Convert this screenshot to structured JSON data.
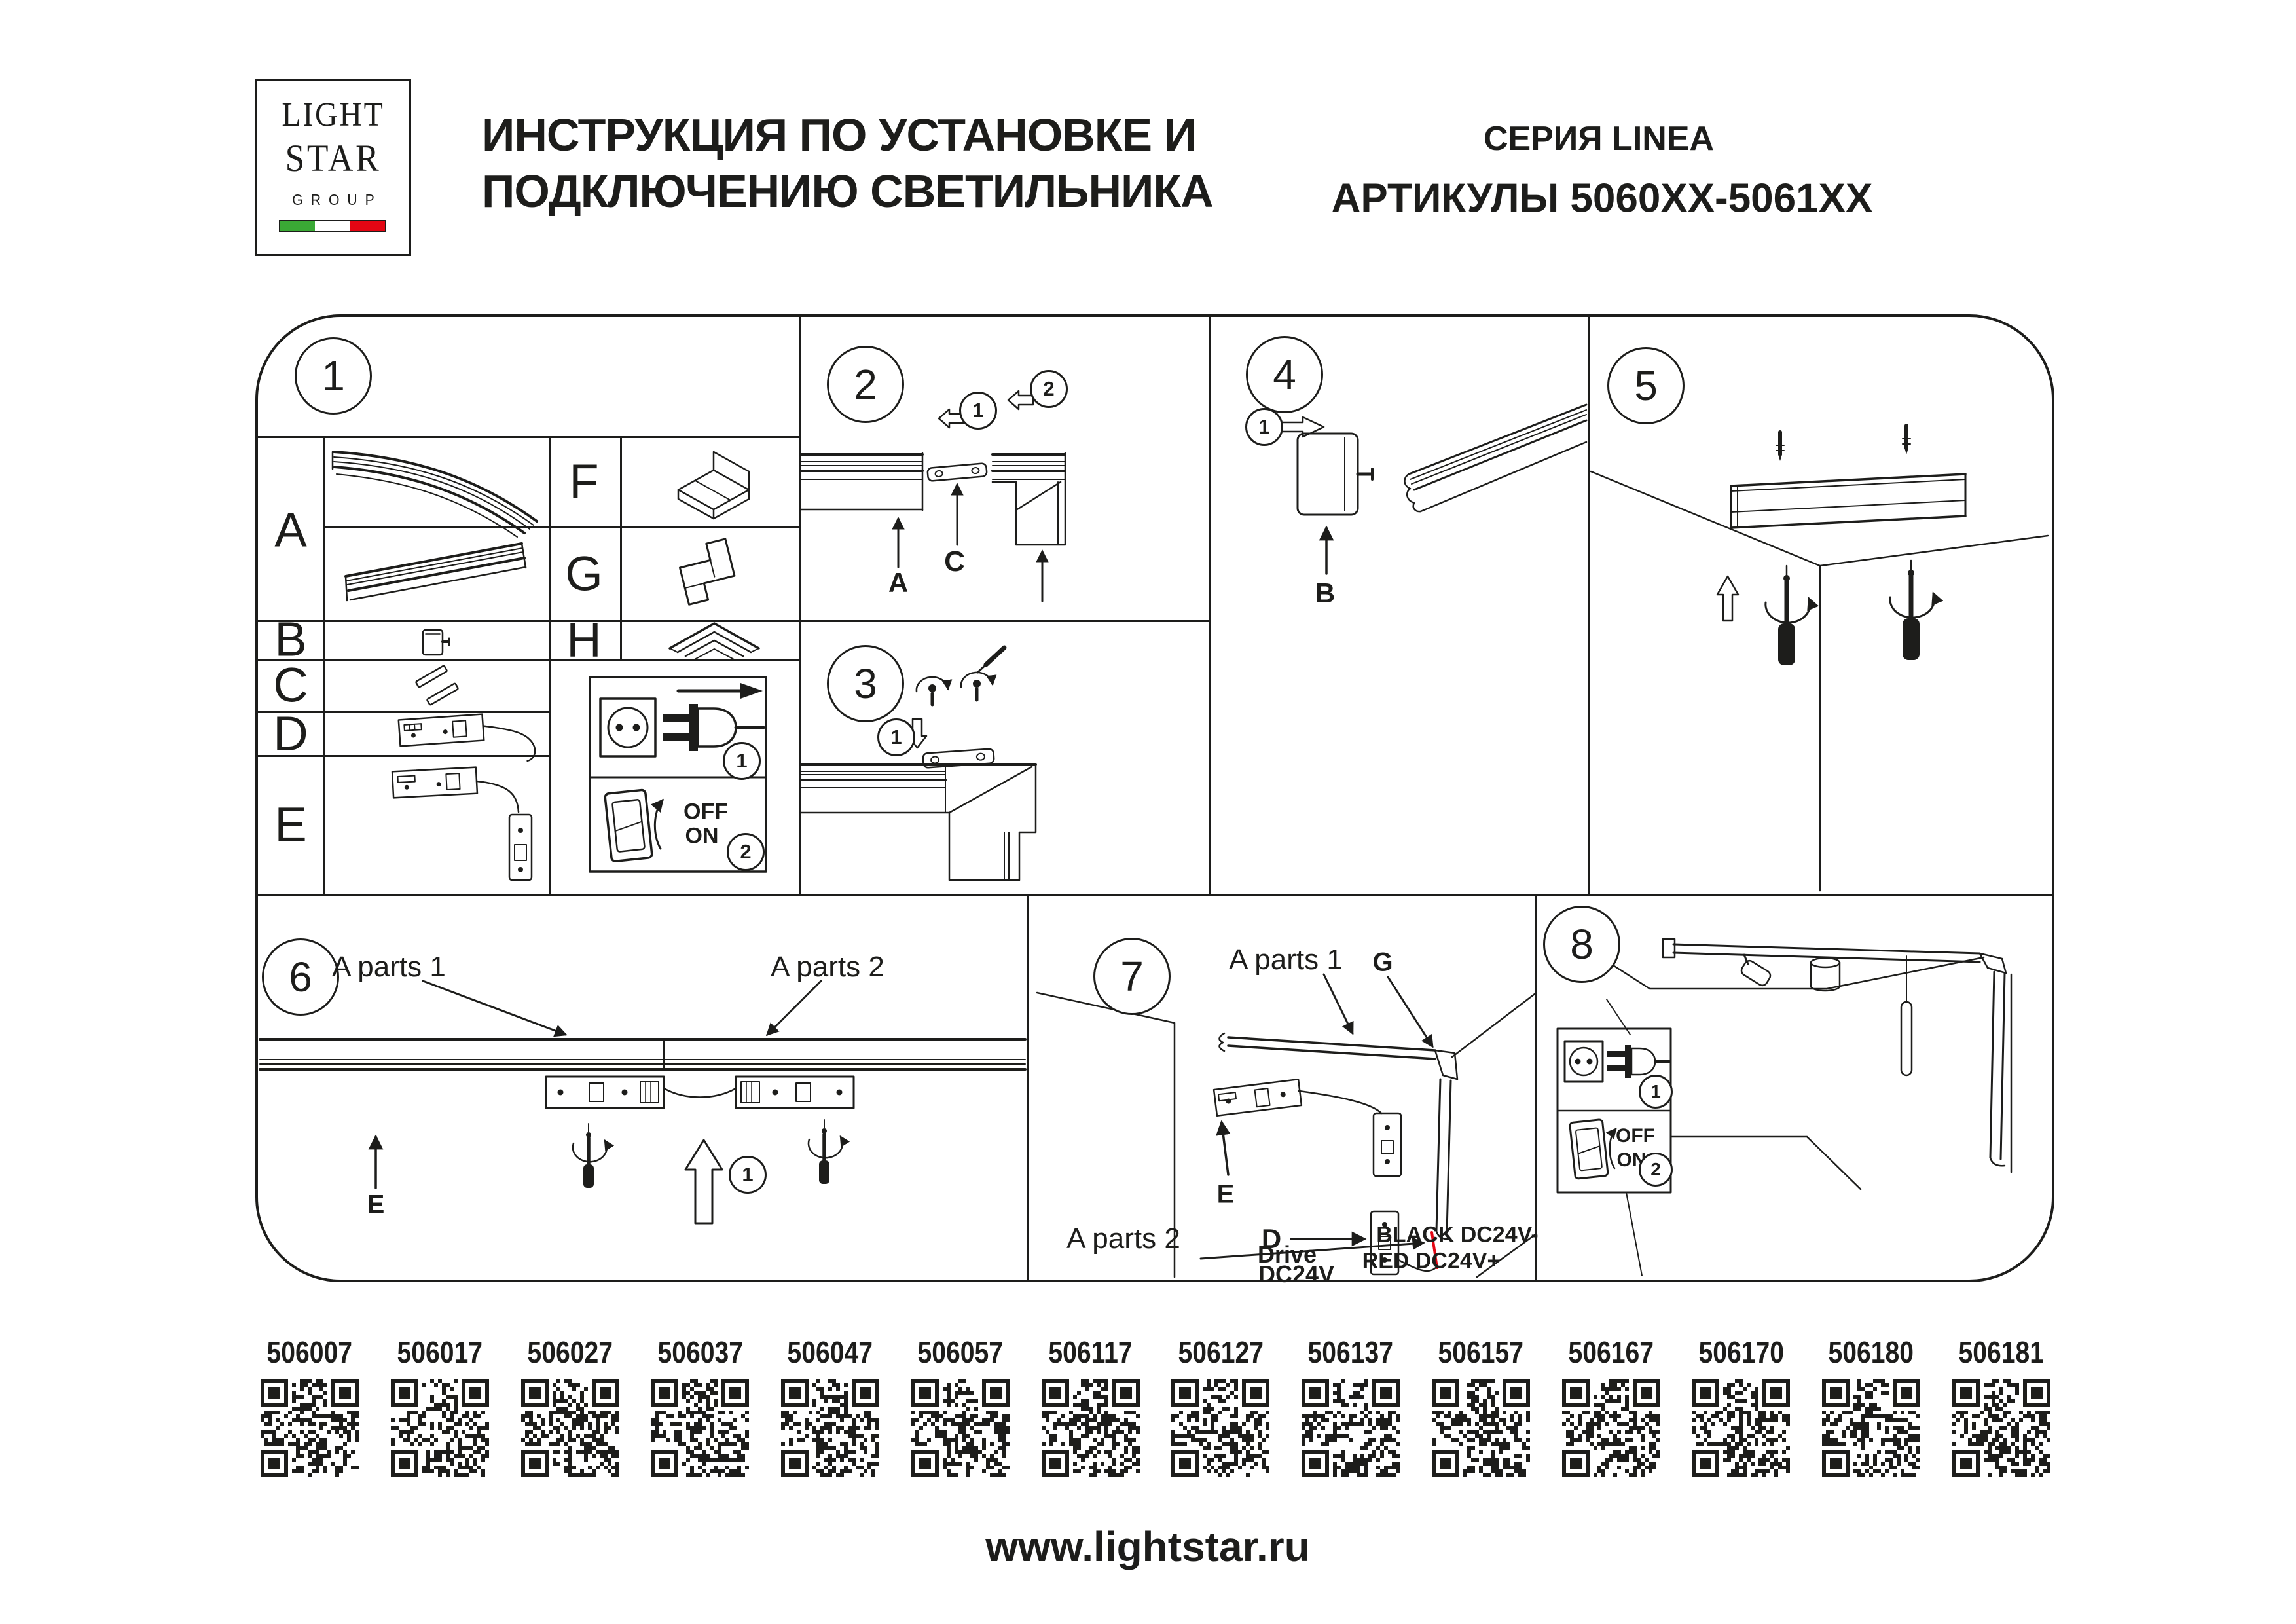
{
  "header": {
    "logo": {
      "line1": "LIGHT",
      "line2": "STAR",
      "line3": "GROUP"
    },
    "title": {
      "line1": "ИНСТРУКЦИЯ ПО УСТАНОВКЕ И",
      "line2": "ПОДКЛЮЧЕНИЮ СВЕТИЛЬНИКА"
    },
    "series": "СЕРИЯ LINEA",
    "articles": "АРТИКУЛЫ 5060XX-5061XX"
  },
  "panels": {
    "p1": {
      "num": "1",
      "row_a": "A",
      "row_b": "B",
      "row_c": "C",
      "row_d": "D",
      "row_e": "E",
      "row_f": "F",
      "row_g": "G",
      "row_h": "H",
      "step_unplug": "1",
      "step_switch": "2",
      "switch_off": "OFF",
      "switch_on": "ON"
    },
    "p2": {
      "num": "2",
      "step1": "1",
      "step2": "2",
      "label_a": "A",
      "label_c": "C"
    },
    "p3": {
      "num": "3",
      "step1": "1"
    },
    "p4": {
      "num": "4",
      "step1": "1",
      "label_b": "B"
    },
    "p5": {
      "num": "5"
    },
    "p6": {
      "num": "6",
      "label_a_parts_1": "A parts 1",
      "label_a_parts_2": "A parts 2",
      "label_e": "E",
      "step1": "1"
    },
    "p7": {
      "num": "7",
      "label_a_parts_1": "A parts 1",
      "label_a_parts_2": "A parts 2",
      "label_g": "G",
      "label_e": "E",
      "label_d": "D",
      "drive_line1": "Drive",
      "drive_line2": "DC24V",
      "wire_black": "BLACK DC24V-",
      "wire_red": "RED DC24V+"
    },
    "p8": {
      "num": "8",
      "step1": "1",
      "step2": "2",
      "switch_off": "OFF",
      "switch_on": "ON"
    }
  },
  "qr": {
    "items": [
      "506007",
      "506017",
      "506027",
      "506037",
      "506047",
      "506057",
      "506117",
      "506127",
      "506137",
      "506157",
      "506167",
      "506170",
      "506180",
      "506181"
    ]
  },
  "footer": {
    "url": "www.lightstar.ru"
  },
  "colors": {
    "ink": "#1d1d1b",
    "red": "#e30613",
    "flag_green": "#3aa935",
    "flag_red": "#e30613"
  }
}
